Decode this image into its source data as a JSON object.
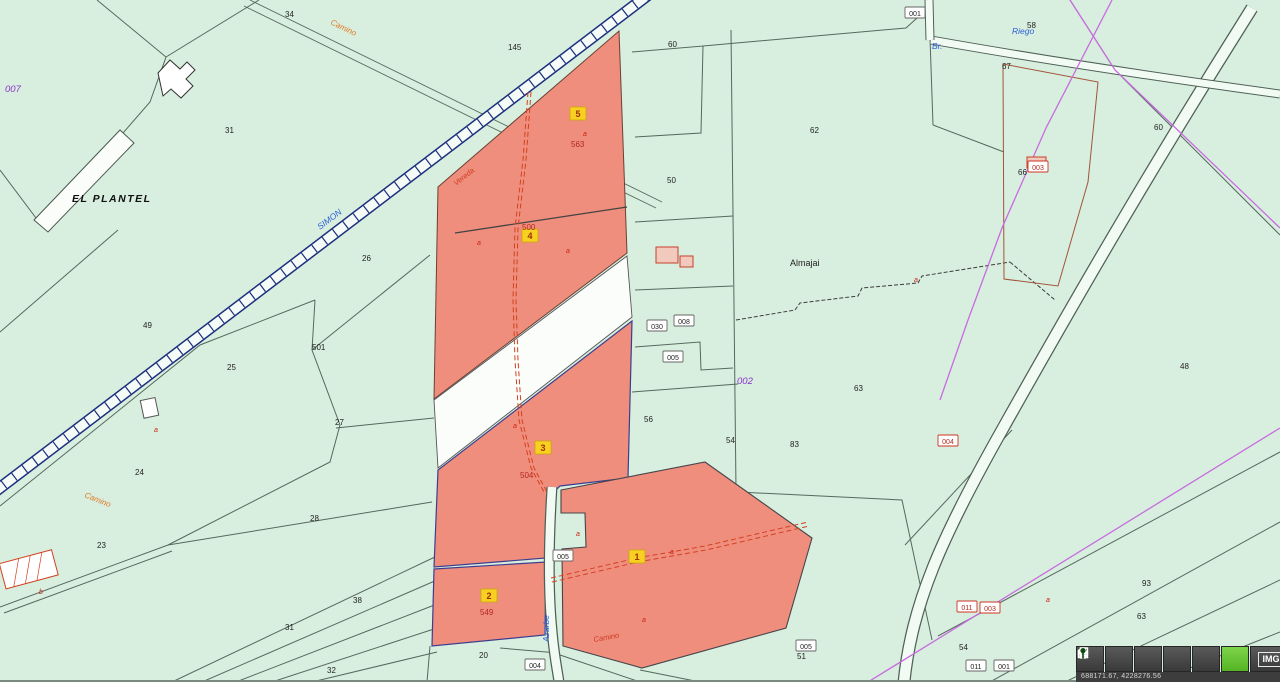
{
  "app": {
    "type": "cadastral-parcel-map-viewer"
  },
  "colors": {
    "background_green": "#d8eede",
    "selection_red": "#ef8e7d",
    "badge_yellow": "#f8d021",
    "railway_navy": "#1b2f7e",
    "road_magenta": "#c86be0",
    "toolbar_green": "#5fc12f"
  },
  "toolbar": {
    "buttons": [
      {
        "id": "chevron",
        "icon": "chevron-right-icon"
      },
      {
        "id": "zoom",
        "icon": "magnifier-icon"
      },
      {
        "id": "copy",
        "icon": "pages-icon"
      },
      {
        "id": "back",
        "icon": "arrow-left-icon"
      },
      {
        "id": "print",
        "icon": "printer-icon"
      },
      {
        "id": "locate",
        "icon": "marker-icon",
        "highlighted": true
      },
      {
        "id": "img",
        "label": "IMG"
      }
    ],
    "img_label": "IMG",
    "status": "688171.67, 4228276.56"
  },
  "map": {
    "selected_parcel_badges": [
      {
        "n": "5",
        "x": 578,
        "y": 117
      },
      {
        "n": "4",
        "x": 530,
        "y": 239
      },
      {
        "n": "3",
        "x": 543,
        "y": 451
      },
      {
        "n": "2",
        "x": 489,
        "y": 599
      },
      {
        "n": "1",
        "x": 637,
        "y": 560
      }
    ],
    "labels": [
      {
        "text": "EL PLANTEL",
        "x": 72,
        "y": 202,
        "cls": "place"
      },
      {
        "text": "Almajai",
        "x": 790,
        "y": 266,
        "cls": "name"
      },
      {
        "text": "007",
        "x": 5,
        "y": 92,
        "cls": "purple"
      },
      {
        "text": "002",
        "x": 737,
        "y": 384,
        "cls": "purple"
      },
      {
        "text": "Riego",
        "x": 1012,
        "y": 34,
        "cls": "blue"
      },
      {
        "text": "Br.",
        "x": 932,
        "y": 49,
        "cls": "blue"
      },
      {
        "text": "SIMON",
        "x": 320,
        "y": 230,
        "cls": "blue",
        "rot": -37
      },
      {
        "text": "Camino",
        "x": 330,
        "y": 24,
        "cls": "orange",
        "rot": 26
      },
      {
        "text": "Camino",
        "x": 84,
        "y": 497,
        "cls": "orange",
        "rot": 22
      },
      {
        "text": "Azarbe",
        "x": 549,
        "y": 642,
        "cls": "blue",
        "rot": -90
      },
      {
        "text": "Vereda",
        "x": 456,
        "y": 186,
        "cls": "redroad",
        "rot": -38
      },
      {
        "text": "Camino",
        "x": 594,
        "y": 642,
        "cls": "redroad",
        "rot": -10
      },
      {
        "text": "563",
        "x": 571,
        "y": 147,
        "cls": "rednum"
      },
      {
        "text": "500",
        "x": 522,
        "y": 230,
        "cls": "rednum"
      },
      {
        "text": "504",
        "x": 520,
        "y": 478,
        "cls": "rednum"
      },
      {
        "text": "549",
        "x": 480,
        "y": 615,
        "cls": "rednum"
      },
      {
        "text": "34",
        "x": 285,
        "y": 17,
        "cls": "num"
      },
      {
        "text": "145",
        "x": 508,
        "y": 50,
        "cls": "num"
      },
      {
        "text": "60",
        "x": 668,
        "y": 47,
        "cls": "num"
      },
      {
        "text": "31",
        "x": 225,
        "y": 133,
        "cls": "num"
      },
      {
        "text": "50",
        "x": 667,
        "y": 183,
        "cls": "num"
      },
      {
        "text": "62",
        "x": 810,
        "y": 133,
        "cls": "num"
      },
      {
        "text": "58",
        "x": 1027,
        "y": 28,
        "cls": "num"
      },
      {
        "text": "67",
        "x": 1002,
        "y": 69,
        "cls": "num"
      },
      {
        "text": "60",
        "x": 1154,
        "y": 130,
        "cls": "num"
      },
      {
        "text": "66",
        "x": 1018,
        "y": 175,
        "cls": "num"
      },
      {
        "text": "26",
        "x": 362,
        "y": 261,
        "cls": "num"
      },
      {
        "text": "49",
        "x": 143,
        "y": 328,
        "cls": "num"
      },
      {
        "text": "501",
        "x": 312,
        "y": 350,
        "cls": "num"
      },
      {
        "text": "25",
        "x": 227,
        "y": 370,
        "cls": "num"
      },
      {
        "text": "27",
        "x": 335,
        "y": 425,
        "cls": "num"
      },
      {
        "text": "24",
        "x": 135,
        "y": 475,
        "cls": "num"
      },
      {
        "text": "56",
        "x": 644,
        "y": 422,
        "cls": "num"
      },
      {
        "text": "63",
        "x": 854,
        "y": 391,
        "cls": "num"
      },
      {
        "text": "48",
        "x": 1180,
        "y": 369,
        "cls": "num"
      },
      {
        "text": "83",
        "x": 790,
        "y": 447,
        "cls": "num"
      },
      {
        "text": "54",
        "x": 726,
        "y": 443,
        "cls": "num"
      },
      {
        "text": "28",
        "x": 310,
        "y": 521,
        "cls": "num"
      },
      {
        "text": "23",
        "x": 97,
        "y": 548,
        "cls": "num"
      },
      {
        "text": "38",
        "x": 353,
        "y": 603,
        "cls": "num"
      },
      {
        "text": "31",
        "x": 285,
        "y": 630,
        "cls": "num"
      },
      {
        "text": "32",
        "x": 327,
        "y": 673,
        "cls": "num"
      },
      {
        "text": "20",
        "x": 479,
        "y": 658,
        "cls": "num"
      },
      {
        "text": "51",
        "x": 797,
        "y": 659,
        "cls": "num"
      },
      {
        "text": "54",
        "x": 959,
        "y": 650,
        "cls": "num"
      },
      {
        "text": "93",
        "x": 1142,
        "y": 586,
        "cls": "num"
      },
      {
        "text": "63",
        "x": 1137,
        "y": 619,
        "cls": "num"
      },
      {
        "text": "a",
        "x": 477,
        "y": 245,
        "cls": "mark"
      },
      {
        "text": "a",
        "x": 566,
        "y": 253,
        "cls": "mark"
      },
      {
        "text": "a",
        "x": 513,
        "y": 428,
        "cls": "mark"
      },
      {
        "text": "a",
        "x": 576,
        "y": 536,
        "cls": "mark"
      },
      {
        "text": "a",
        "x": 642,
        "y": 622,
        "cls": "mark"
      },
      {
        "text": "a",
        "x": 670,
        "y": 554,
        "cls": "mark"
      },
      {
        "text": "a",
        "x": 154,
        "y": 432,
        "cls": "mark"
      },
      {
        "text": "b",
        "x": 39,
        "y": 594,
        "cls": "mark"
      },
      {
        "text": "a",
        "x": 914,
        "y": 282,
        "cls": "mark"
      },
      {
        "text": "a",
        "x": 1046,
        "y": 602,
        "cls": "mark"
      },
      {
        "text": "a",
        "x": 583,
        "y": 136,
        "cls": "mark"
      }
    ],
    "chips_white": [
      {
        "t": "001",
        "x": 915,
        "y": 13
      },
      {
        "t": "030",
        "x": 657,
        "y": 326
      },
      {
        "t": "008",
        "x": 684,
        "y": 321
      },
      {
        "t": "005",
        "x": 673,
        "y": 357
      },
      {
        "t": "005",
        "x": 563,
        "y": 556
      },
      {
        "t": "004",
        "x": 535,
        "y": 665
      },
      {
        "t": "005",
        "x": 806,
        "y": 646
      },
      {
        "t": "011",
        "x": 976,
        "y": 666
      },
      {
        "t": "001",
        "x": 1004,
        "y": 666
      }
    ],
    "chips_red": [
      {
        "t": "011",
        "x": 967,
        "y": 607
      },
      {
        "t": "003",
        "x": 990,
        "y": 608
      },
      {
        "t": "004",
        "x": 948,
        "y": 441
      },
      {
        "t": "003",
        "x": 1038,
        "y": 167
      }
    ]
  }
}
